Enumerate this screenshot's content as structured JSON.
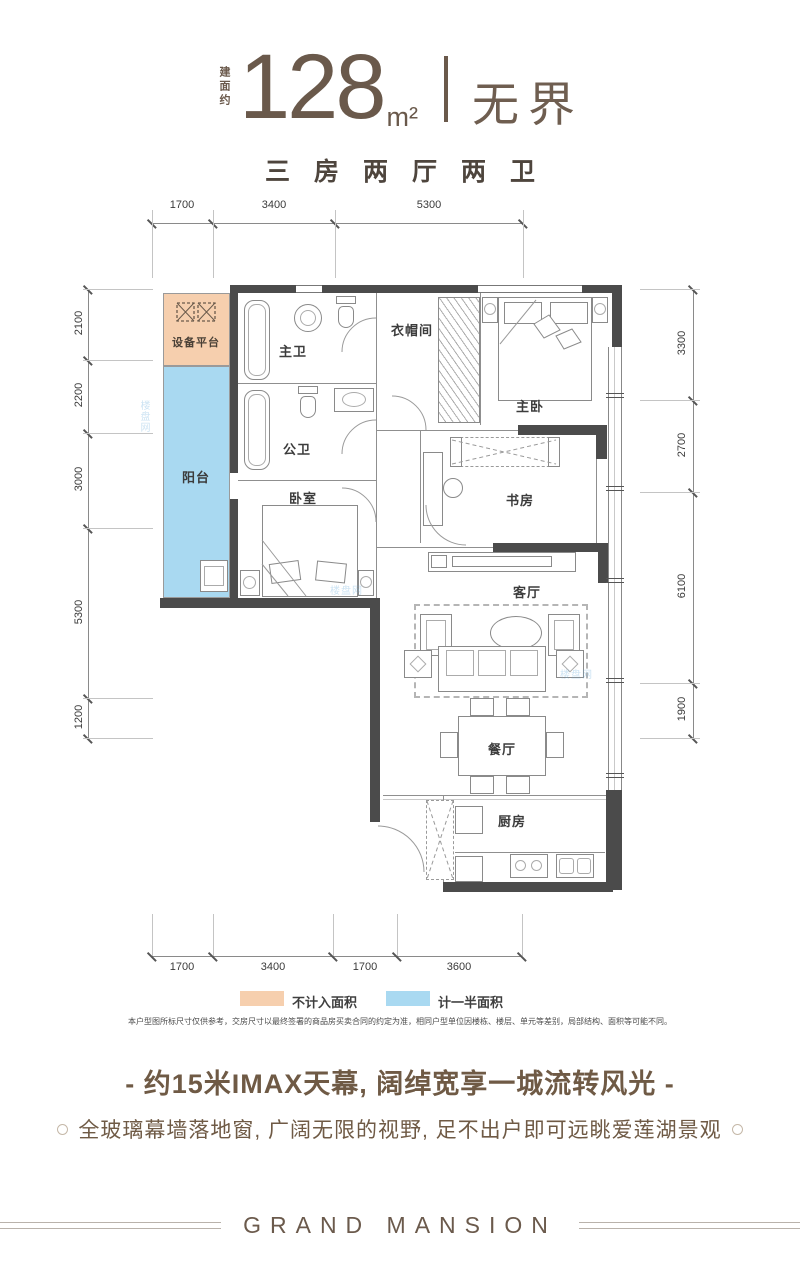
{
  "header": {
    "area_prefix": "建面约",
    "area_value": "128",
    "area_unit": "m²",
    "title": "无界",
    "layout": "三房两厅两卫"
  },
  "plan": {
    "labels": {
      "equipment": "设备平台",
      "balcony": "阳台",
      "master_bath": "主卫",
      "public_bath": "公卫",
      "bedroom": "卧室",
      "cloakroom": "衣帽间",
      "master_bedroom": "主卧",
      "study": "书房",
      "living": "客厅",
      "dining": "餐厅",
      "kitchen": "厨房"
    },
    "dims": {
      "top": [
        "1700",
        "3400",
        "5300"
      ],
      "bottom": [
        "1700",
        "3400",
        "1700",
        "3600"
      ],
      "left": [
        "2100",
        "2200",
        "3000",
        "5300",
        "1200"
      ],
      "right": [
        "3300",
        "2700",
        "6100",
        "1900"
      ]
    }
  },
  "legend": {
    "items": [
      {
        "label": "不计入面积",
        "color": "#f6cfae"
      },
      {
        "label": "计一半面积",
        "color": "#a9d9f1"
      }
    ]
  },
  "notes": {
    "disclaimer": "本户型图所标尺寸仅供参考，交房尺寸以最终签署的商品房买卖合同的约定为准，相同户型单位因楼栋、楼层、单元等差别，局部结构、面积等可能不同。"
  },
  "marketing": {
    "headline": "- 约15米IMAX天幕, 阔绰宽享一城流转风光 -",
    "subline": "全玻璃幕墙落地窗, 广阔无限的视野, 足不出户即可远眺爱莲湖景观"
  },
  "footer": {
    "brand": "GRAND MANSION"
  },
  "watermark": {
    "text": "楼盘网"
  },
  "colors": {
    "accent_brown": "#6a594b",
    "wall": "#4b4b4b",
    "area_not_counted": "#f6cfae",
    "area_half_counted": "#a9d9f1"
  }
}
